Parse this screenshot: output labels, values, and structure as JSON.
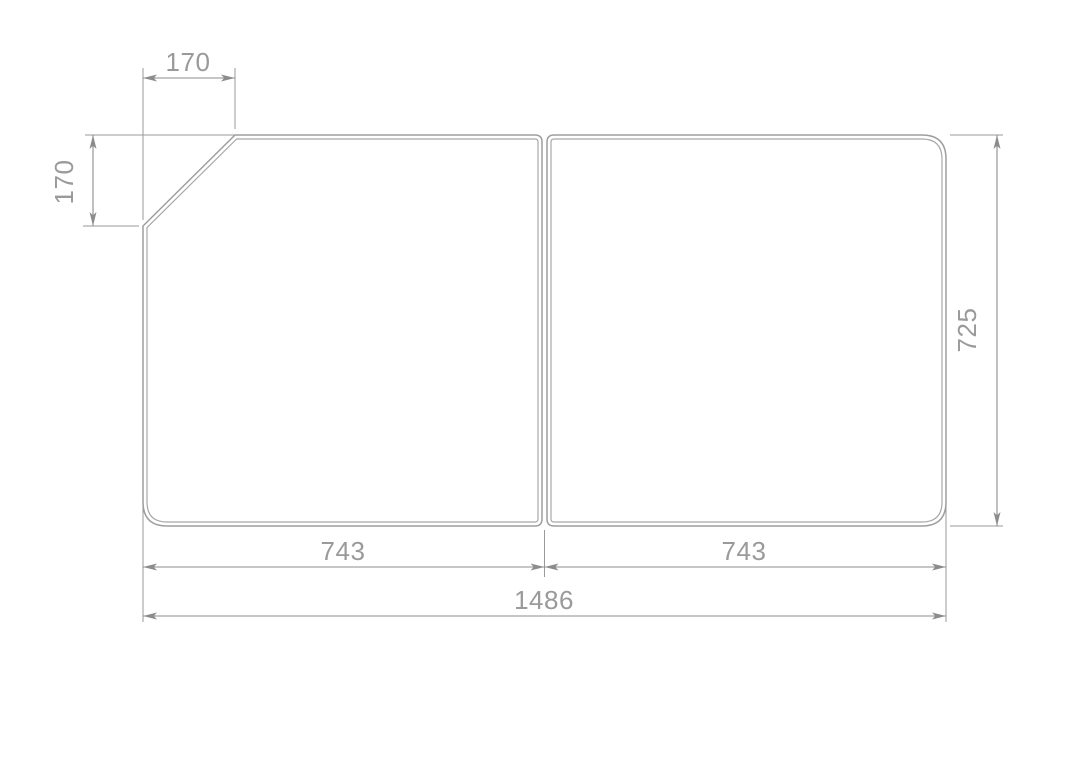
{
  "drawing": {
    "description": "Technical dimension drawing of a two-piece panel (bath lid) with chamfered top-left corner",
    "colors": {
      "background": "#ffffff",
      "object_line": "#9e9e9e",
      "dimension_line": "#8c8c8c",
      "text": "#9a9a9a"
    },
    "dimensions": {
      "top_chamfer_width": "170",
      "left_chamfer_height": "170",
      "panel_height": "725",
      "left_panel_width": "743",
      "right_panel_width": "743",
      "total_width": "1486"
    }
  }
}
